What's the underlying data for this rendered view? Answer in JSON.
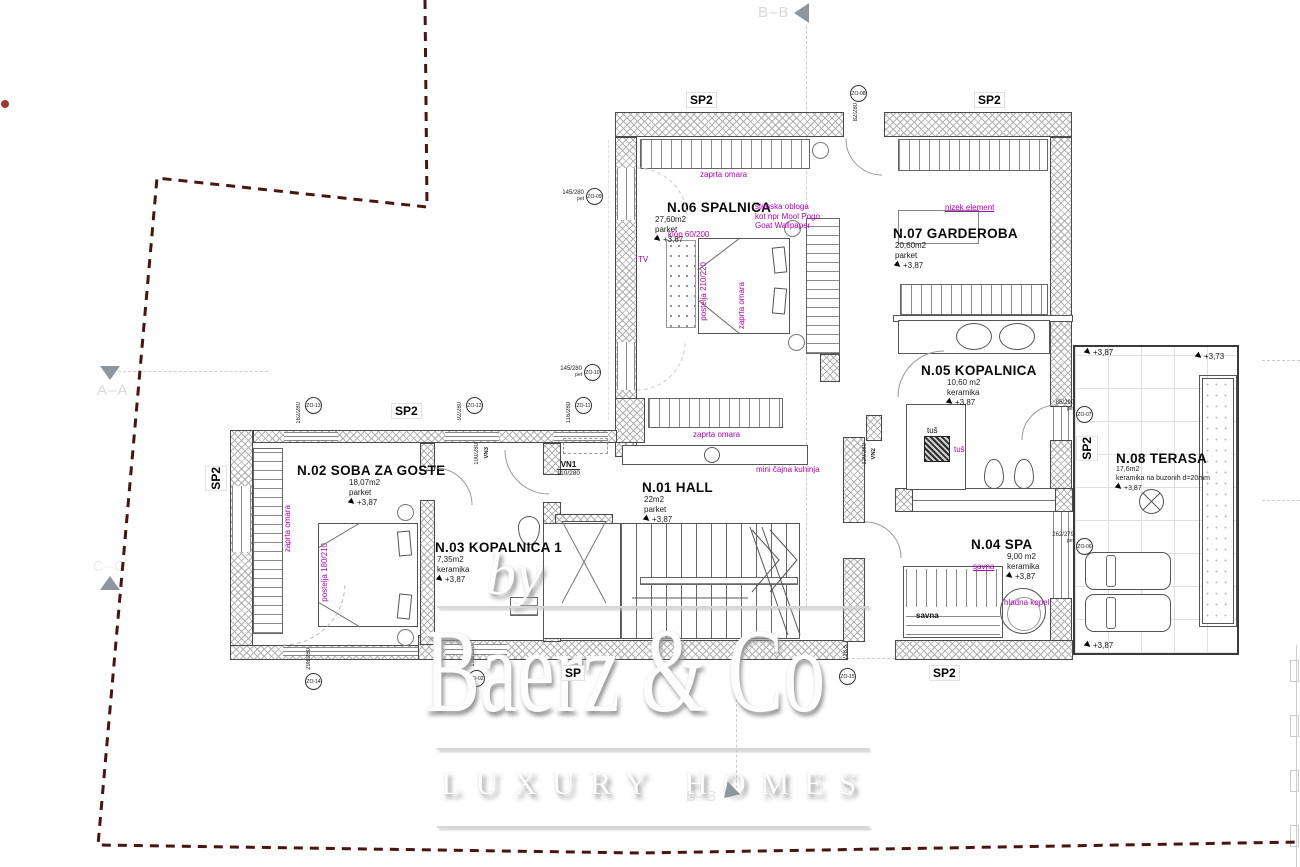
{
  "colors": {
    "annotation": "#b400b4",
    "boundary": "#4a1412",
    "accent_dot": "#a63232"
  },
  "watermark": {
    "by": "by",
    "brand": "Baerz & Co",
    "tagline": "LUXURY HOMES"
  },
  "sections": {
    "top": "B–B",
    "left_a": "A–A",
    "left_c": "C–C",
    "bottom": "B–B"
  },
  "rooms": [
    {
      "name": "N.06 SPALNICA",
      "area": "27,60m2",
      "floor": "parket",
      "level": "+3,87"
    },
    {
      "name": "N.07 GARDEROBA",
      "area": "20,60m2",
      "floor": "parket",
      "level": "+3,87"
    },
    {
      "name": "N.05 KOPALNICA",
      "area": "10,60 m2",
      "floor": "keramika",
      "level": "+3,87"
    },
    {
      "name": "N.01 HALL",
      "area": "22m2",
      "floor": "parket",
      "level": "+3,87"
    },
    {
      "name": "N.02 SOBA ZA GOSTE",
      "area": "18,07m2",
      "floor": "parket",
      "level": "+3,87"
    },
    {
      "name": "N.03 KOPALNICA 1",
      "area": "7,35m2",
      "floor": "keramika",
      "level": "+3,87"
    },
    {
      "name": "N.04 SPA",
      "area": "9,00 m2",
      "floor": "keramika",
      "level": "+3,87"
    },
    {
      "name": "N.08 TERASA",
      "area": "17,6m2",
      "floor": "keramika na buzonih d=20mm",
      "level": "+3,87"
    }
  ],
  "labels": {
    "sp2": "SP2",
    "sp": "SP"
  },
  "doors": {
    "vn1": "VN1",
    "vn1_dim": "110/280",
    "vn2": "VN2",
    "vn2_dim": "120/280",
    "vn3": "VN3",
    "vn3_dim": "100/280"
  },
  "windows": [
    {
      "id": "ZO-08",
      "dim": "82/280"
    },
    {
      "id": "ZO-09",
      "dim": "145/280"
    },
    {
      "id": "ZO-10",
      "dim": "145/280"
    },
    {
      "id": "ZO-13",
      "dim": "162/280"
    },
    {
      "id": "ZO-12",
      "dim": "92/280"
    },
    {
      "id": "ZO-11",
      "dim": "116/280"
    },
    {
      "id": "ZO-14",
      "dim": "298/280"
    },
    {
      "id": "ZO-02",
      "dim": "195/280"
    },
    {
      "id": "ZO-15",
      "dim": "218,5"
    },
    {
      "id": "ZO-07",
      "dim": "85/290"
    },
    {
      "id": "ZO-06",
      "dim": "262/279"
    }
  ],
  "window_note": "pet",
  "annotations": {
    "zaprta_omara": "zaprta omara",
    "postelja_n06": "postelja 210/220",
    "postelja_n02": "postelja 180/210",
    "klop": "klop 60/200",
    "tv": "TV",
    "wallpaper_1": "stenska obloga",
    "wallpaper_2": "kot npr Mool Pogo",
    "wallpaper_3": "Goat Wallpaper",
    "nizek_element": "nizek element",
    "mini_kuhinja": "mini čajna kuhinja",
    "tus": "tuš",
    "savna": "savna",
    "hladna_kopel": "hladna kopel"
  },
  "fixtures": {
    "savna_text": "savna",
    "tus_text": "tuš"
  },
  "elevations": {
    "main": "+3,87",
    "terrace_upper": "+3,73"
  }
}
